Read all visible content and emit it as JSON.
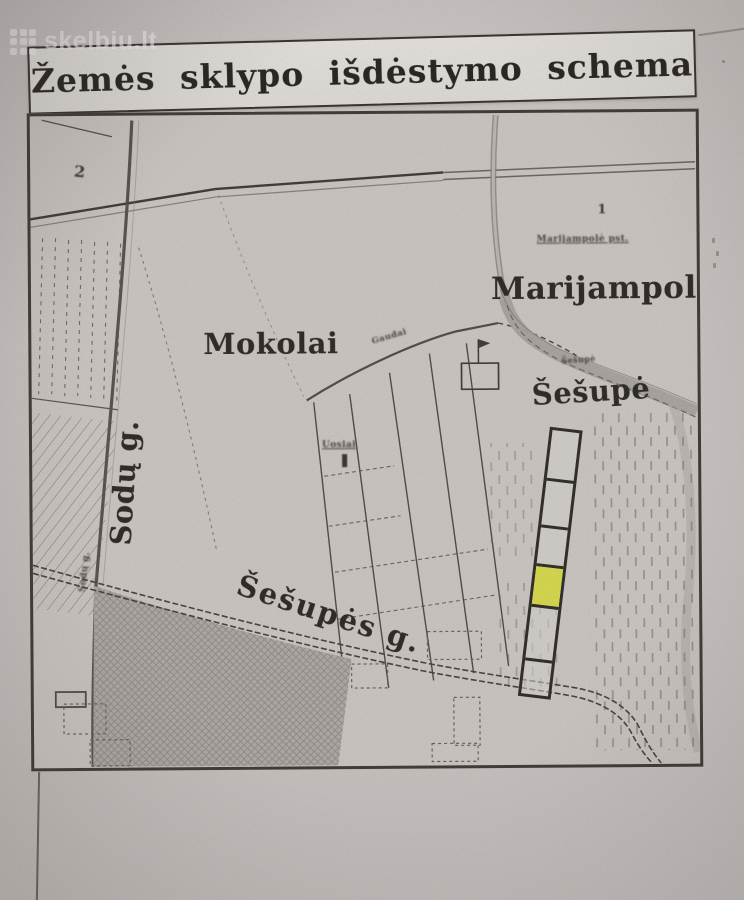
{
  "watermark": {
    "text": "skelbiu.lt"
  },
  "title": "Žemės sklypo išdėstymo schema",
  "map": {
    "labels": {
      "city": "Marijampolė",
      "station_small": "Marijampolė pst.",
      "station_marker": "1",
      "grid_marker": "2",
      "settlement": "Mokolai",
      "river": "Šešupė",
      "river_small": "Šešupė",
      "street_sodu": "Sodų g.",
      "street_sodu_small": "Sodų g.",
      "street_sesupes": "Šešupės g.",
      "road_small": "Gaudai",
      "plot_block_small": "Uosiai"
    },
    "plot_strip": {
      "cells": 6,
      "highlighted_cell": 4,
      "highlight_color": "#dfe153"
    },
    "colors": {
      "paper": "#d6d0cd",
      "map_paper": "#d3cec9",
      "ink": "#403b36",
      "shaded_block": "#b6b1ad",
      "river": "#aeaaa5",
      "highlight": "#dfe153"
    }
  }
}
